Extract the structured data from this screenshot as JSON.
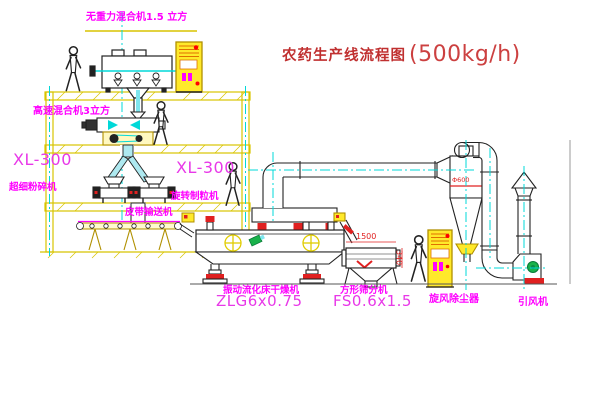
{
  "title": {
    "cn": "农药生产线流程图",
    "capacity": "(500kg/h)"
  },
  "labels": {
    "mixer1": "无重力混合机1.5 立方",
    "mixer2": "高速混合机3立方",
    "crusher_model": "XL-300",
    "crusher": "超细粉碎机",
    "granulator_model": "XL-300",
    "granulator": "旋转制粒机",
    "belt": "皮带输送机",
    "dryer": "振动流化床干燥机",
    "dryer_model": "ZLG6x0.75",
    "sieve": "方形筛分机",
    "sieve_model": "FS0.6x1.5",
    "cyclone": "旋风除尘器",
    "fan": "引风机"
  },
  "dimensions": {
    "sieve_length": "1500",
    "sieve_height": "340",
    "cyclone_diameter": "Φ600"
  },
  "colors": {
    "structure_yellow": "#d8c400",
    "cabinet_yellow": "#ffe92a",
    "centerline_cyan": "#00d8d8",
    "label_magenta": "#ff00ff",
    "model_magenta": "#e838e8",
    "title_red": "#c03030",
    "dim_red": "#e02020",
    "motor_green": "#19b24b"
  }
}
